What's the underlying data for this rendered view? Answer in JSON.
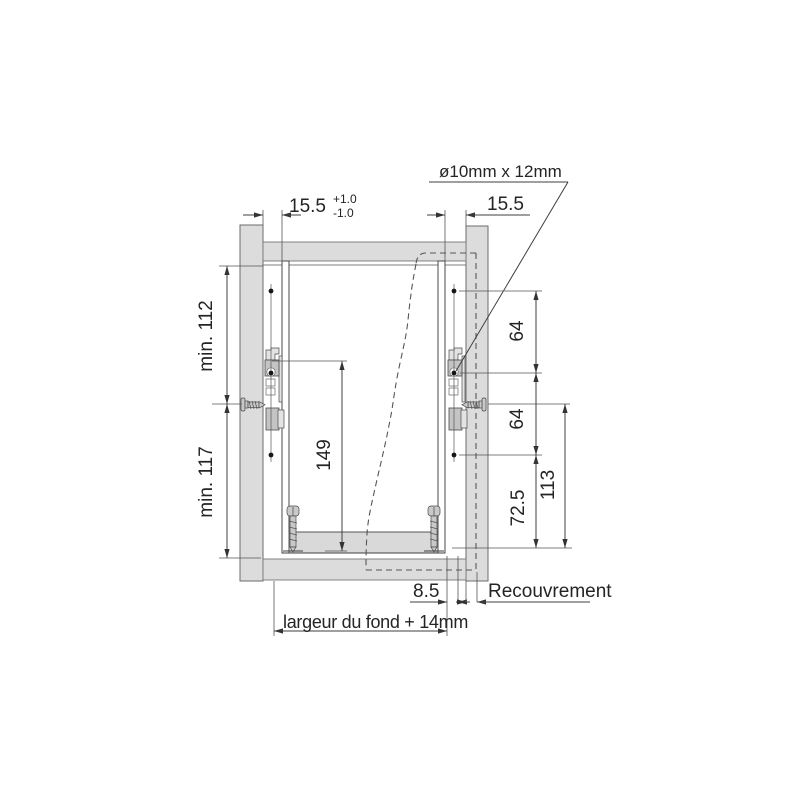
{
  "drawing": {
    "callout_label": "ø10mm x 12mm",
    "top_left_dim": "15.5",
    "top_left_tol_plus": "+1.0",
    "top_left_tol_minus": "-1.0",
    "top_right_dim": "15.5",
    "left_upper_dim": "min. 112",
    "left_lower_dim": "min. 117",
    "inner_height_dim": "149",
    "right_upper_dim": "64",
    "right_middle_dim": "64",
    "right_lower_dim": "72.5",
    "right_overall_dim": "113",
    "bottom_offset_dim": "8.5",
    "overlay_label": "Recouvrement",
    "bottom_width_label": "largeur du fond + 14mm"
  },
  "colors": {
    "background": "#ffffff",
    "panel_fill": "#dcdcdc",
    "slide_fill": "#c4c4c4",
    "line": "#4a4a4a",
    "dimension_line": "#3f3f3f",
    "text": "#242424"
  }
}
